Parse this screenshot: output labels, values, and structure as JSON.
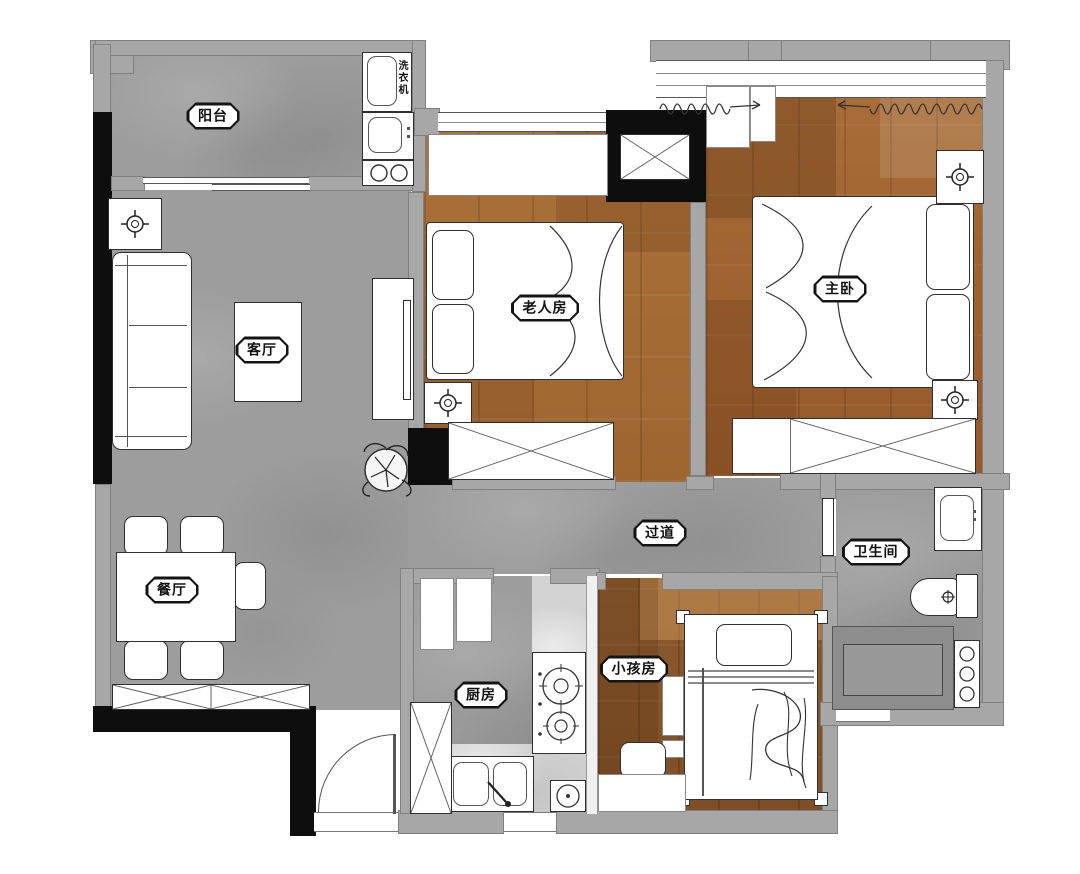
{
  "rooms": {
    "balcony": "阳台",
    "living_room": "客厅",
    "dining_room": "餐厅",
    "elder_room": "老人房",
    "master_bedroom": "主卧",
    "hallway": "过道",
    "bathroom": "卫生间",
    "kitchen": "厨房",
    "kids_room": "小孩房"
  },
  "appliances": {
    "washing_machine": "洗衣机"
  },
  "colors": {
    "background": "#ffffff",
    "tile_floor": "#9d9d9d",
    "wood_floor_light": "#ab713a",
    "wood_floor_dark": "#8c5a2e",
    "kitchen_marble": "#d2d2d2",
    "wall_black": "#0e0e0e",
    "wall_gray": "#a7a7a7",
    "furniture_outline": "#2f2f2f",
    "furniture_fill": "#ffffff"
  }
}
